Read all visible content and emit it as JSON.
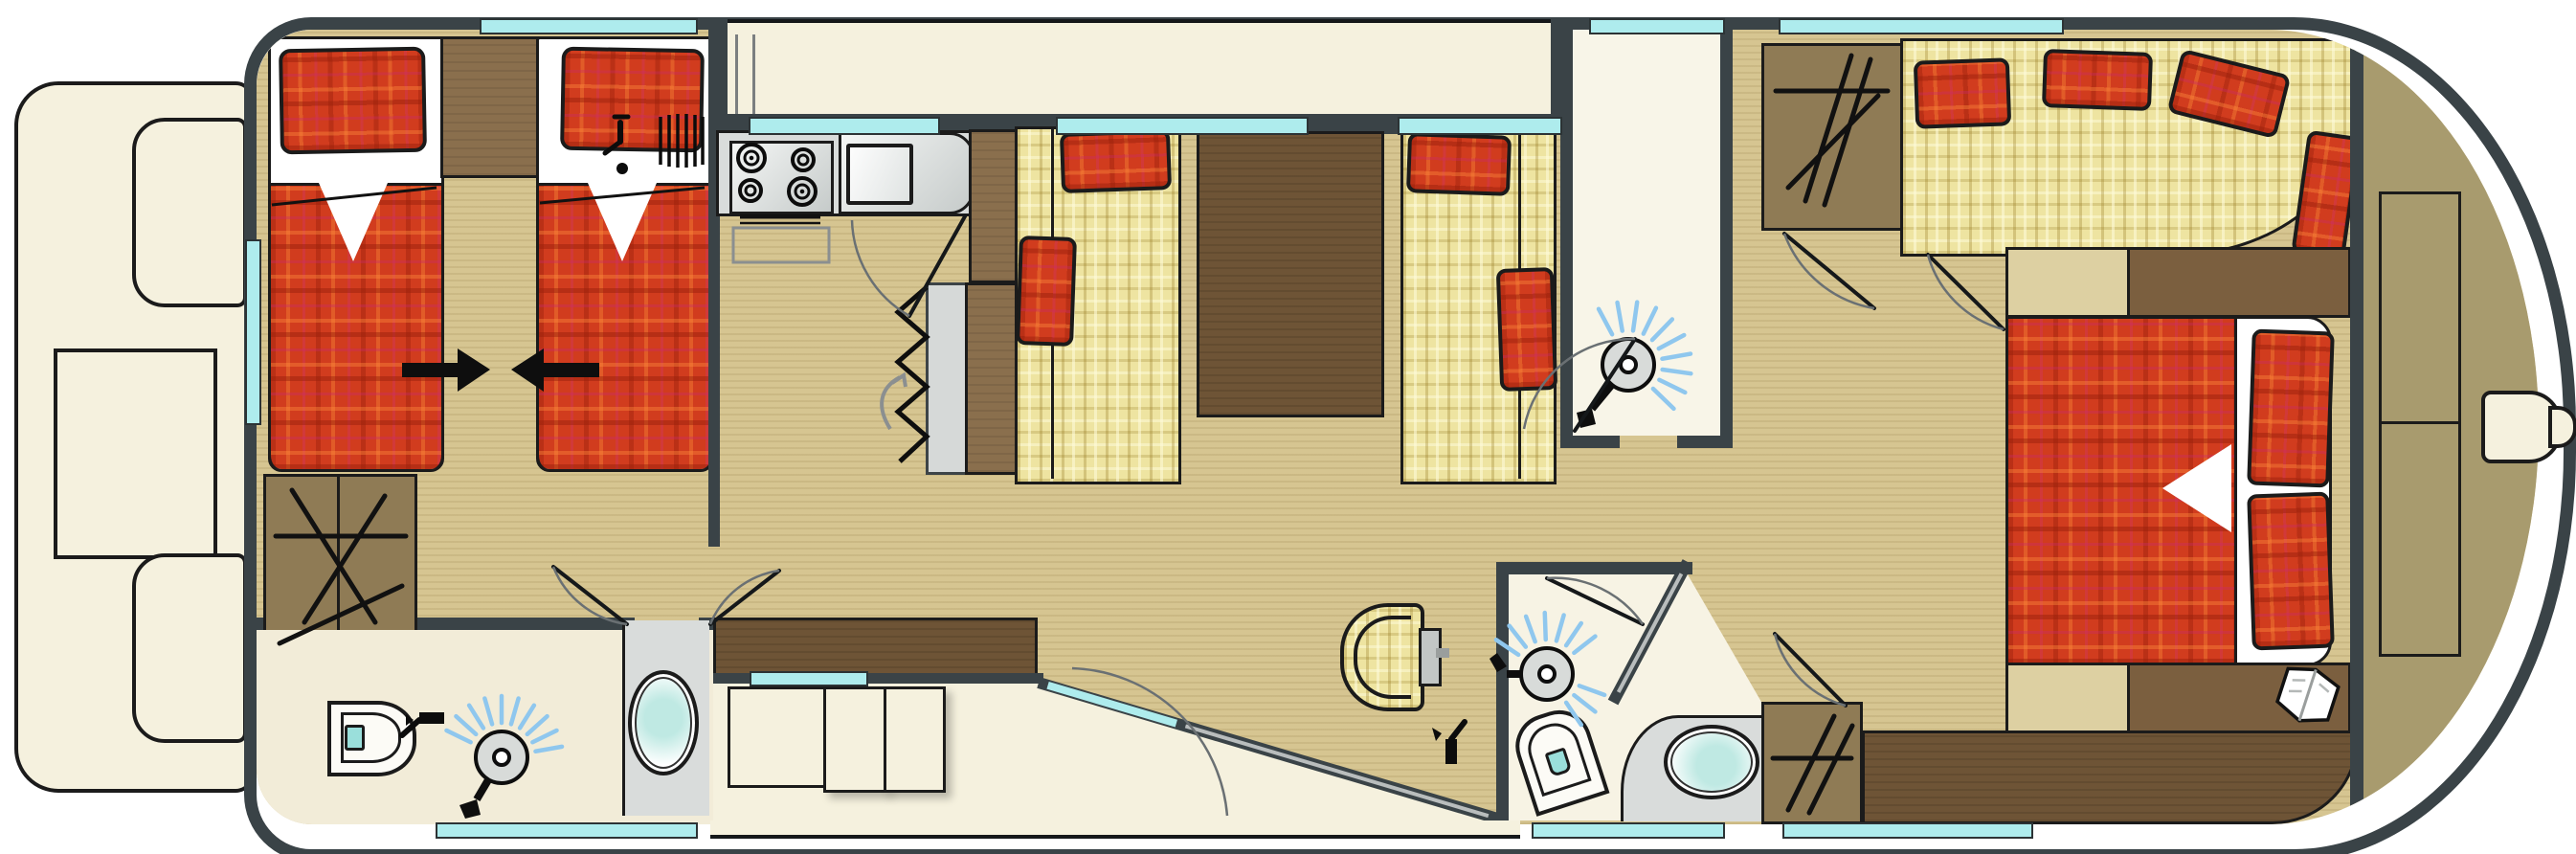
{
  "meta": {
    "type": "floor-plan",
    "subject": "Canal cruiser houseboat deck plan, top view",
    "orientation": "bow at left, rounded stern at right",
    "visible_text": "none"
  },
  "colors": {
    "hull": "#3a4347",
    "window_glass": "#aeeced",
    "interior_floor": "#d6c591",
    "exterior_deck": "#f5f1de",
    "stern_deck": "#a89b6e",
    "upholstery_yellow": "#eee4a1",
    "bedding_red": "#d13c1e",
    "furniture_dark_walnut": "#6e5436",
    "furniture_oak": "#8a6f4d",
    "wardrobe_brown": "#8f7b55",
    "counter_gray": "#d9dcdb",
    "fixture_white": "#fcfbf6",
    "water_teal": "#bfe9e3",
    "spray_blue": "#8fc7ee",
    "bench_tan": "#ddd0a2",
    "outline": "#1b1b1b"
  },
  "areas": {
    "bow_deck": {
      "label": "Bow deck with seats and locker",
      "items": [
        "bench seat",
        "locker",
        "bench seat"
      ]
    },
    "front_cabin": {
      "label": "Front cabin with two joinable single beds",
      "items": [
        "single bed port",
        "single bed starboard",
        "nightstand",
        "bed join arrows",
        "wardrobe"
      ]
    },
    "front_bathroom": {
      "label": "Front bathroom",
      "items": [
        "toilet",
        "shower head",
        "washbasin on counter"
      ]
    },
    "galley": {
      "label": "Galley",
      "items": [
        "four burner stove",
        "oven",
        "sink with drainer",
        "tall cabinet fridge",
        "companionway stairs"
      ]
    },
    "saloon": {
      "label": "Saloon dinette",
      "items": [
        "sofa bench port",
        "dining table",
        "sofa bench starboard",
        "red cushions",
        "helm seat",
        "helm console",
        "sideboard",
        "sliding patio door",
        "cockpit steps"
      ]
    },
    "mid_shower_room": {
      "label": "Shower room",
      "items": [
        "shower head"
      ]
    },
    "mid_wardrobe": {
      "label": "Wardrobe with hangers"
    },
    "aft_bathroom": {
      "label": "Aft bathroom",
      "items": [
        "shower head",
        "toilet",
        "washbasin on counter"
      ]
    },
    "aft_wardrobe": {
      "label": "Aft wardrobe with hangers"
    },
    "aft_lounge": {
      "label": "Aft lounge curved bench",
      "cushions": 4
    },
    "aft_cabin": {
      "label": "Aft double cabin",
      "items": [
        "double bed",
        "two pillows",
        "two nightstands",
        "two tan benches",
        "long dresser",
        "book on nightstand"
      ]
    },
    "stern_deck": {
      "label": "Stern deck",
      "items": [
        "deck locker",
        "deck locker",
        "swim step / rudder pod"
      ]
    },
    "windows": {
      "label": "Hull windows",
      "count": 12
    }
  }
}
